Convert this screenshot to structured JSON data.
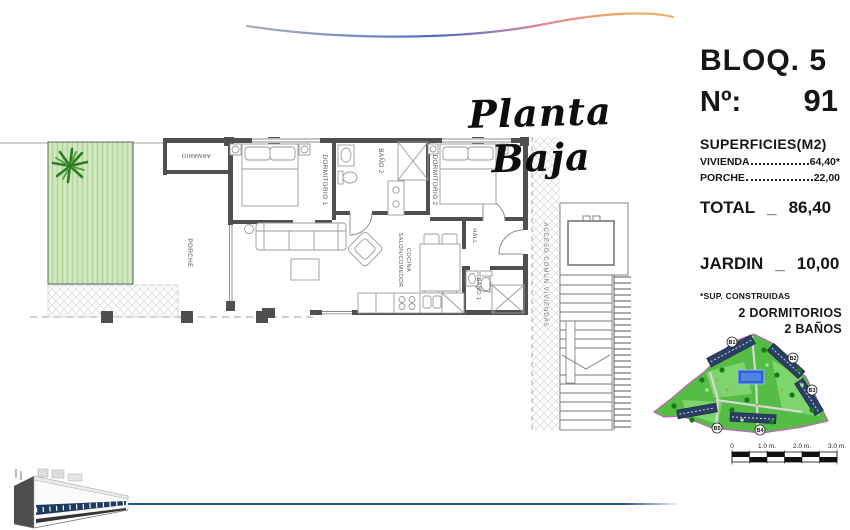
{
  "title": "Planta Baja",
  "info_panel": {
    "block": "BLOQ. 5",
    "unit_label": "Nº:",
    "unit_number": "91",
    "surfaces_heading": "SUPERFICIES(M2)",
    "rows": [
      {
        "label": "VIVIENDA",
        "value": "64,40*"
      },
      {
        "label": "PORCHE",
        "value": "22,00"
      }
    ],
    "total_label": "TOTAL",
    "total_sep": "_",
    "total_value": "86,40",
    "jardin_label": "JARDIN",
    "jardin_sep": "_",
    "jardin_value": "10,00",
    "footnote": "*SUP. CONSTRUIDAS",
    "features": [
      "2 DORMITORIOS",
      "2 BAÑOS"
    ]
  },
  "floorplan": {
    "rooms": {
      "porche": "PORCHE",
      "armario": "ARMARIO",
      "dormitorio1": "DORMITORIO 1",
      "bano2": "BAÑO 2",
      "dormitorio2": "DORMITORIO 2",
      "hall": "HALL",
      "salon_line1": "SALON/COMEDOR",
      "salon_line2": "COCINA",
      "bano1": "BAÑO 1",
      "acceso": "ACCESO COMUN VIVIENDAS"
    }
  },
  "site_plan": {
    "building_labels": [
      "B1",
      "B2",
      "B3",
      "B4",
      "B5"
    ],
    "scale_ticks": [
      "0",
      "1.0 m.",
      "2.0 m.",
      "3.0 m."
    ]
  },
  "colors": {
    "garden_green": "#d2e9c0",
    "palm_green": "#2e7d22",
    "map_green": "#55bd45",
    "pool_blue": "#2e62cf",
    "map_border_magenta": "#c45fc4",
    "wall_gray": "#4f4f4f",
    "accent_blue_line": "#27568c"
  }
}
